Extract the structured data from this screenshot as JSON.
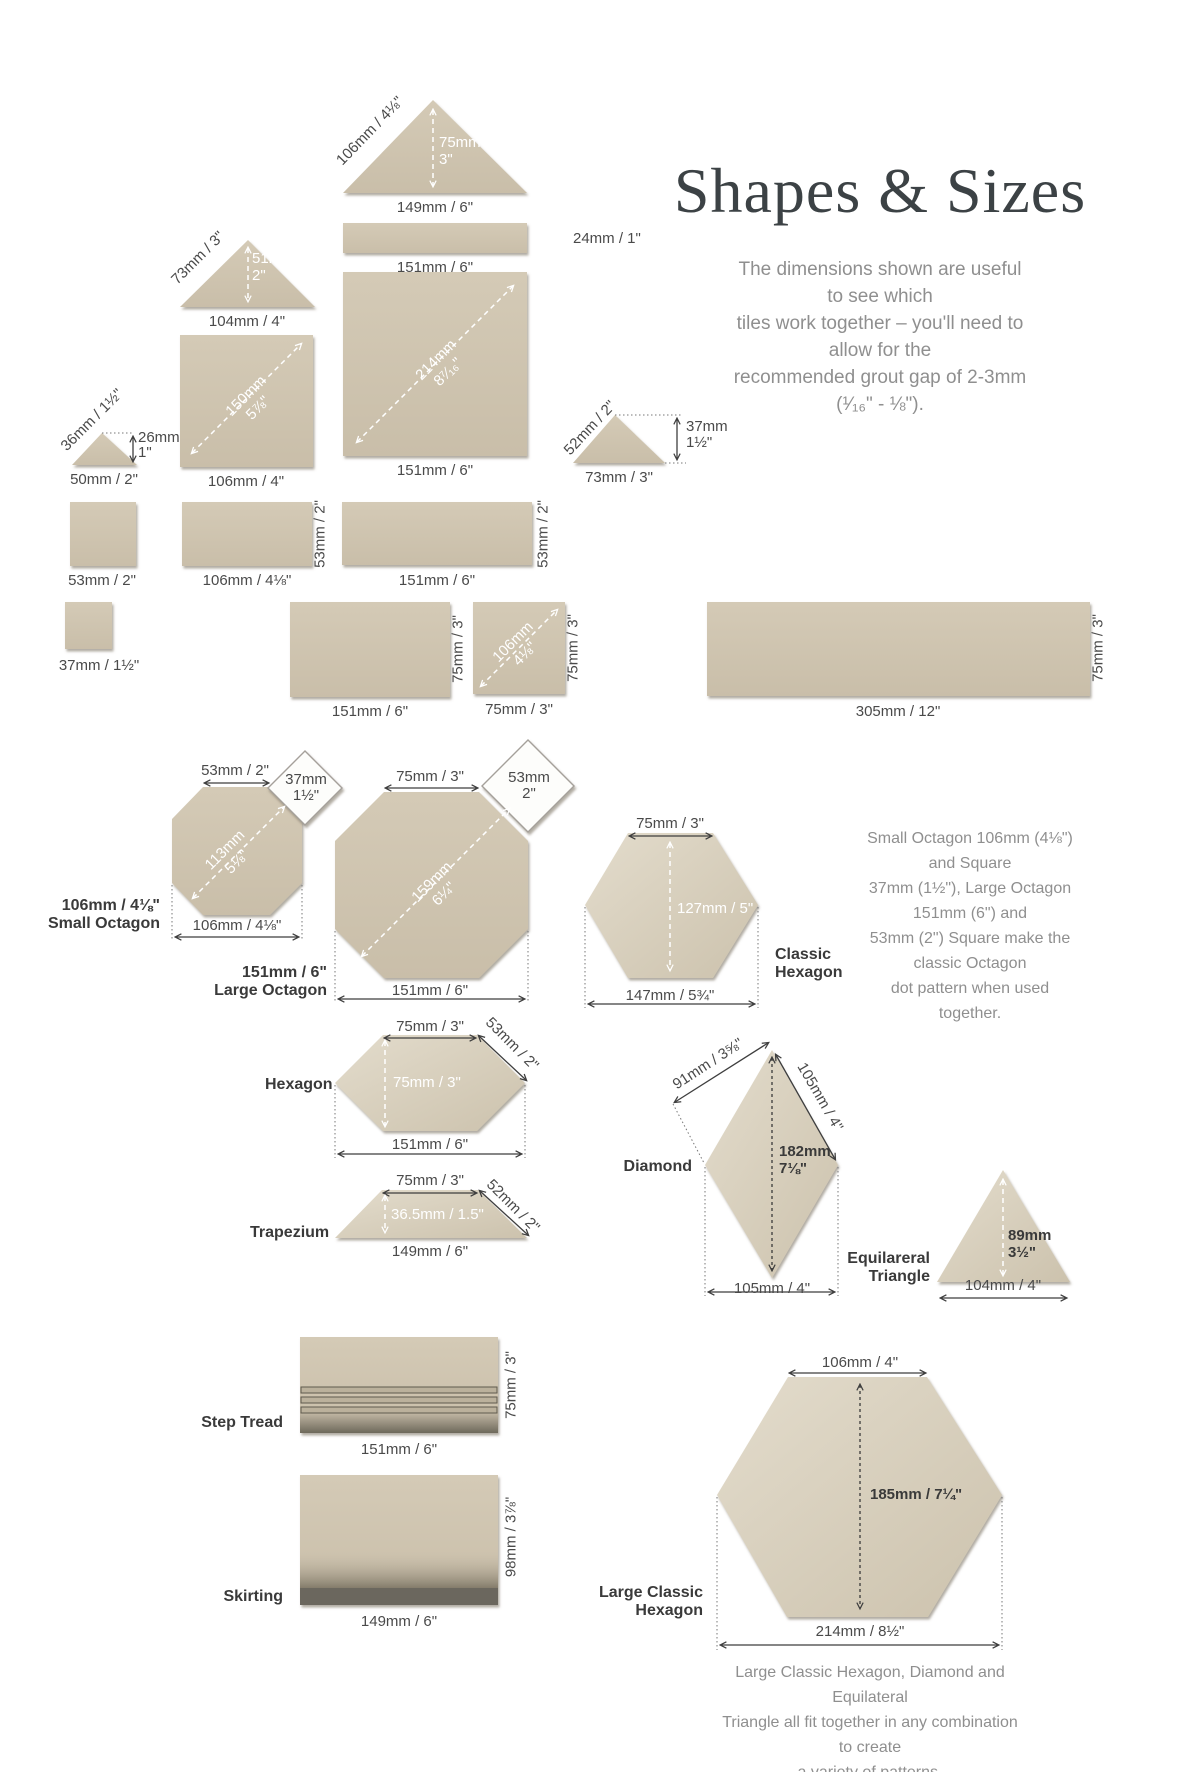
{
  "header": {
    "title": "Shapes & Sizes",
    "subtitle": "The dimensions shown are useful to see which\ntiles work together – you'll need to allow for the\nrecommended grout gap of 2-3mm (¹⁄₁₆\" - ⅛\")."
  },
  "top": {
    "tri149": {
      "hyp": "106mm / 4⅛\"",
      "height": "75mm\n3\"",
      "base": "149mm / 6\""
    },
    "rect24": {
      "side": "24mm / 1\"",
      "base": "151mm / 6\""
    },
    "sq151": {
      "diag": "214mm\n8⁷⁄₁₆\"",
      "base": "151mm / 6\""
    },
    "tri104": {
      "hyp": "73mm / 3\"",
      "height": "51mm\n2\"",
      "base": "104mm / 4\""
    },
    "sq106": {
      "diag": "150mm\n5⅞\"",
      "base": "106mm / 4\""
    },
    "tri50": {
      "hyp": "36mm / 1½\"",
      "height": "26mm\n1\"",
      "base": "50mm / 2\""
    },
    "tri73": {
      "hyp": "52mm / 2\"",
      "height": "37mm\n1½\"",
      "base": "73mm / 3\""
    },
    "sq53": {
      "base": "53mm / 2\""
    },
    "rect106x53": {
      "base": "106mm / 4⅛\"",
      "side": "53mm / 2\""
    },
    "rect151x53": {
      "base": "151mm / 6\"",
      "side": "53mm / 2\""
    },
    "sq37": {
      "base": "37mm / 1½\""
    },
    "rect151x75": {
      "base": "151mm / 6\"",
      "side": "75mm / 3\""
    },
    "sq75": {
      "diag": "106mm\n4⅛\"",
      "base": "75mm / 3\"",
      "side": "75mm / 3\""
    },
    "rect305": {
      "base": "305mm / 12\"",
      "side": "75mm / 3\""
    }
  },
  "octagons": {
    "small": {
      "top": "53mm / 2\"",
      "square": "37mm\n1½\"",
      "diag": "113mm\n5⅛\"",
      "width": "106mm / 4⅛\"",
      "name": "106mm / 4⅛\"\nSmall Octagon"
    },
    "large": {
      "top": "75mm / 3\"",
      "square": "53mm\n2\"",
      "diag": "159mm\n6¼\"",
      "width": "151mm / 6\"",
      "name": "151mm / 6\"\nLarge Octagon"
    },
    "classic_hexagon": {
      "top": "75mm / 3\"",
      "height": "127mm / 5\"",
      "width": "147mm / 5¾\"",
      "name": "Classic\nHexagon"
    },
    "note": "Small Octagon 106mm (4⅛\") and Square\n37mm (1½\"), Large Octagon 151mm (6\") and\n53mm (2\") Square make the classic Octagon\ndot pattern when used together."
  },
  "shapes": {
    "hexagon": {
      "name": "Hexagon",
      "top": "75mm / 3\"",
      "slant": "53mm / 2\"",
      "height": "75mm / 3\"",
      "width": "151mm / 6\""
    },
    "trapezium": {
      "name": "Trapezium",
      "top": "75mm / 3\"",
      "slant": "52mm / 2\"",
      "height": "36.5mm / 1.5\"",
      "base": "149mm / 6\""
    },
    "diamond": {
      "name": "Diamond",
      "upper": "91mm / 3⅝\"",
      "side": "105mm / 4\"",
      "height": "182mm\n7⅛\"",
      "width": "105mm / 4\""
    },
    "equilateral_triangle": {
      "name": "Equilareral\nTriangle",
      "height": "89mm\n3½\"",
      "base": "104mm / 4\""
    }
  },
  "profiles": {
    "step_tread": {
      "name": "Step Tread",
      "base": "151mm / 6\"",
      "side": "75mm / 3\""
    },
    "skirting": {
      "name": "Skirting",
      "base": "149mm / 6\"",
      "side": "98mm / 3⅞\""
    },
    "large_classic_hexagon": {
      "name": "Large Classic\nHexagon",
      "top": "106mm / 4\"",
      "height": "185mm / 7¼\"",
      "width": "214mm / 8½\""
    },
    "note": "Large Classic Hexagon, Diamond and Equilateral\nTriangle all fit together in any combination to create\na variety of patterns."
  },
  "colors": {
    "tile": "#cfc5b1",
    "tile_dark": "#6b675e",
    "text": "#4a4a4a",
    "muted": "#8f8f8f",
    "heading": "#3c4245"
  }
}
